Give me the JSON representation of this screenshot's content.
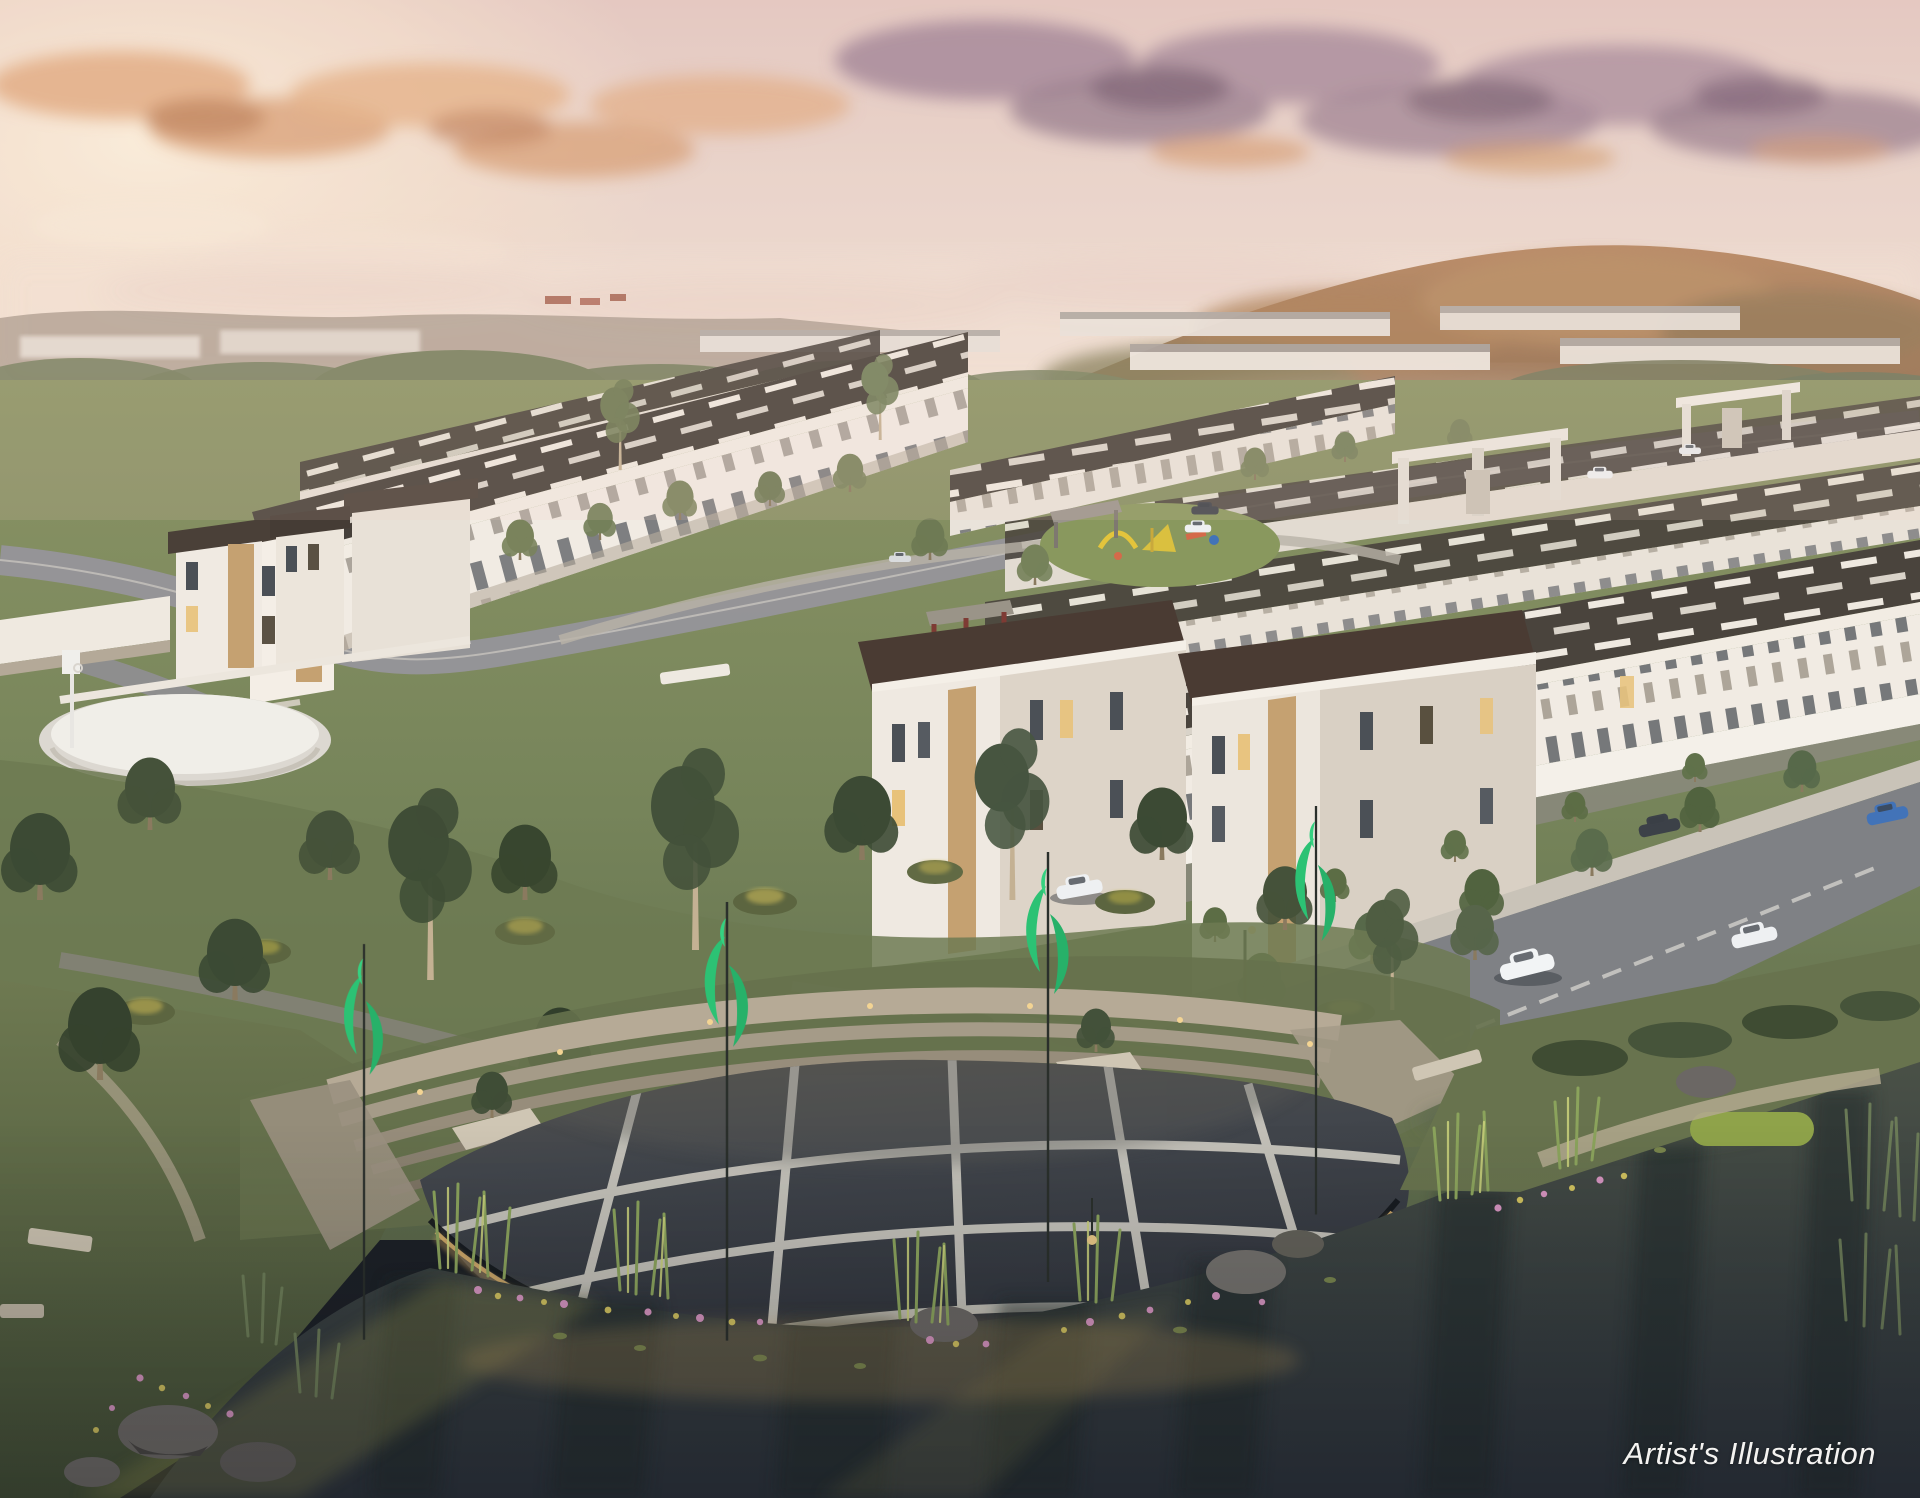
{
  "meta": {
    "type": "artist-architectural-render",
    "subject": "Aerial dusk view of a terraced residential township with central park, basketball court, playground, entrance gates and a lakeside amphitheatre plaza"
  },
  "caption": {
    "text": "Artist's Illustration"
  },
  "palette": {
    "sky_top": "#e7cfc6",
    "sky_glow": "#fdf3df",
    "cloud_warm": "#e0a87c",
    "cloud_mauve": "#977b91",
    "hill_left": "#a89a8c",
    "hill_right": "#b3835c",
    "treeline": "#77815f",
    "grass": "#7d8a5c",
    "grass_dark": "#4d593b",
    "road": "#96959a",
    "path": "#b3a98f",
    "facade": "#f1ebe3",
    "facade_shade": "#d9d1c5",
    "roof": "#46403a",
    "roof_gap": "#efe9e0",
    "accent_tan": "#c5a171",
    "window_lit": "#e8c27a",
    "concrete": "#b6aa96",
    "plaza": "#3f434a",
    "plaza_line": "#d5d2c8",
    "banner_green": "#2cc274",
    "water_top": "#4c5348",
    "water_deep": "#2d333c",
    "glow_warm": "#dcb36e",
    "flower_pink": "#d493be",
    "flower_gold": "#cfc05e",
    "playground_yellow": "#e3c43c",
    "gazebo_red": "#7e3b34",
    "car_blue": "#4273b8",
    "caption": "#f4f3f1"
  }
}
